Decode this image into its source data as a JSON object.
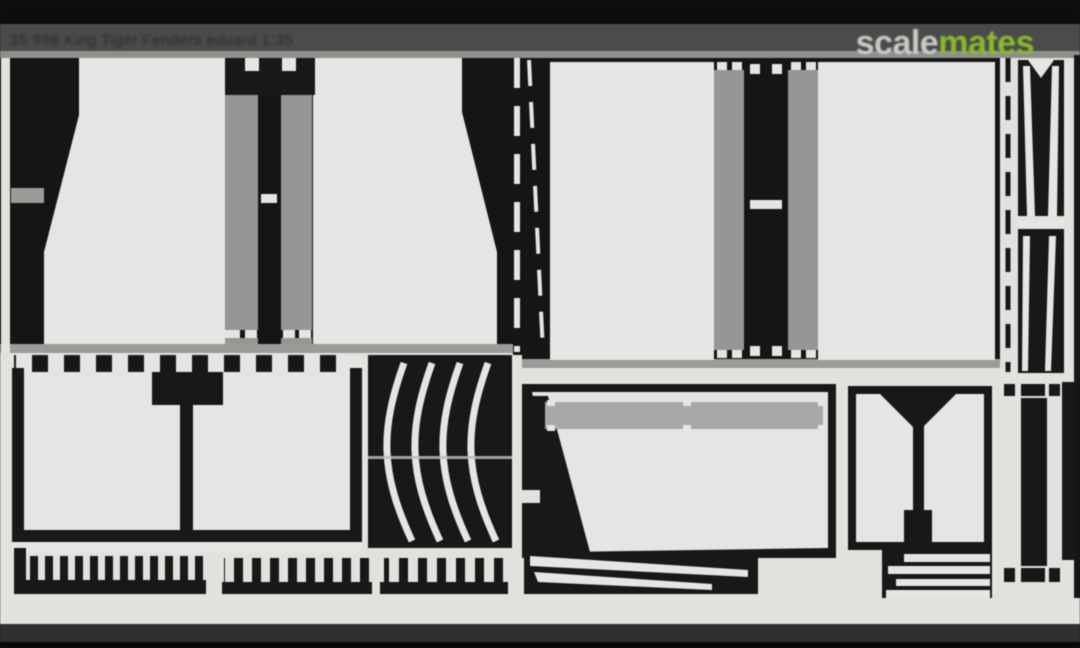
{
  "header": {
    "caption": "35 998  King Tiger  Fenders   eduard  1:35",
    "watermark": {
      "part1": "scale",
      "part2": "mates"
    }
  },
  "photo": {
    "subject": "photo-etched metal detail-parts fret (scale model accessory) on black background",
    "parts": [
      "fender-panel-top-left",
      "fender-panel-top-right",
      "hinge-strip",
      "side-skirt-panel",
      "tray-with-castellated-edge",
      "curved-fender-ribs",
      "comb-strip",
      "engine-deck-panel",
      "blade-strips",
      "hatch-panel",
      "stacked-strips",
      "narrow-fork-strips"
    ]
  },
  "colors": {
    "header_black": "#0d0d0d",
    "header_bar": "#4b4b49",
    "caption_text": "#2b2b29",
    "watermark_gray": "#c9cbc7",
    "watermark_green": "#8aba2c",
    "fret_background": "#151515",
    "metal_light": "#e3e6e3",
    "metal_mid_gray": "#949793",
    "metal_bar_gray": "#a6a9a5",
    "web_gray": "#9a9c98",
    "bottom_light_band": "#e0e2de",
    "bottom_dark_band": "#2f312e",
    "bottom_black": "#0a0a0a"
  }
}
